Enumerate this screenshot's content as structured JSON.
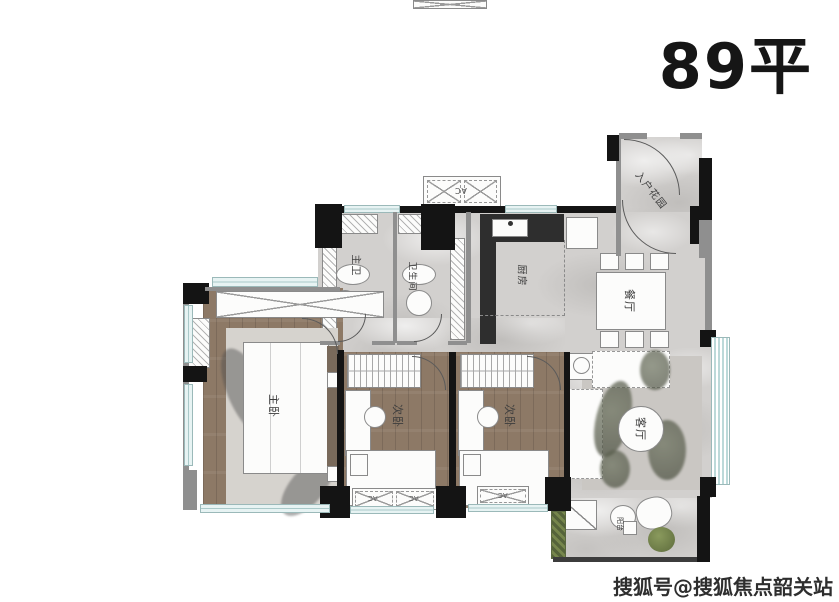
{
  "title": "89平",
  "watermark": "搜狐号@搜狐焦点韶关站",
  "rooms": {
    "entry_garden": "入户花园",
    "kitchen": "厨房",
    "dining": "餐厅",
    "living": "客厅",
    "master_bath": "主卫",
    "bath": "卫生间",
    "master_bedroom": "主卧",
    "bedroom2": "次卧",
    "bedroom3": "次卧",
    "balcony": "阳台",
    "ac": "AC"
  },
  "colors": {
    "wall": "#141414",
    "wood_floor": "#8d7966",
    "marble_floor": "#d2d0ce",
    "window": "#a9c9c9",
    "plant_green": "#76864c"
  }
}
